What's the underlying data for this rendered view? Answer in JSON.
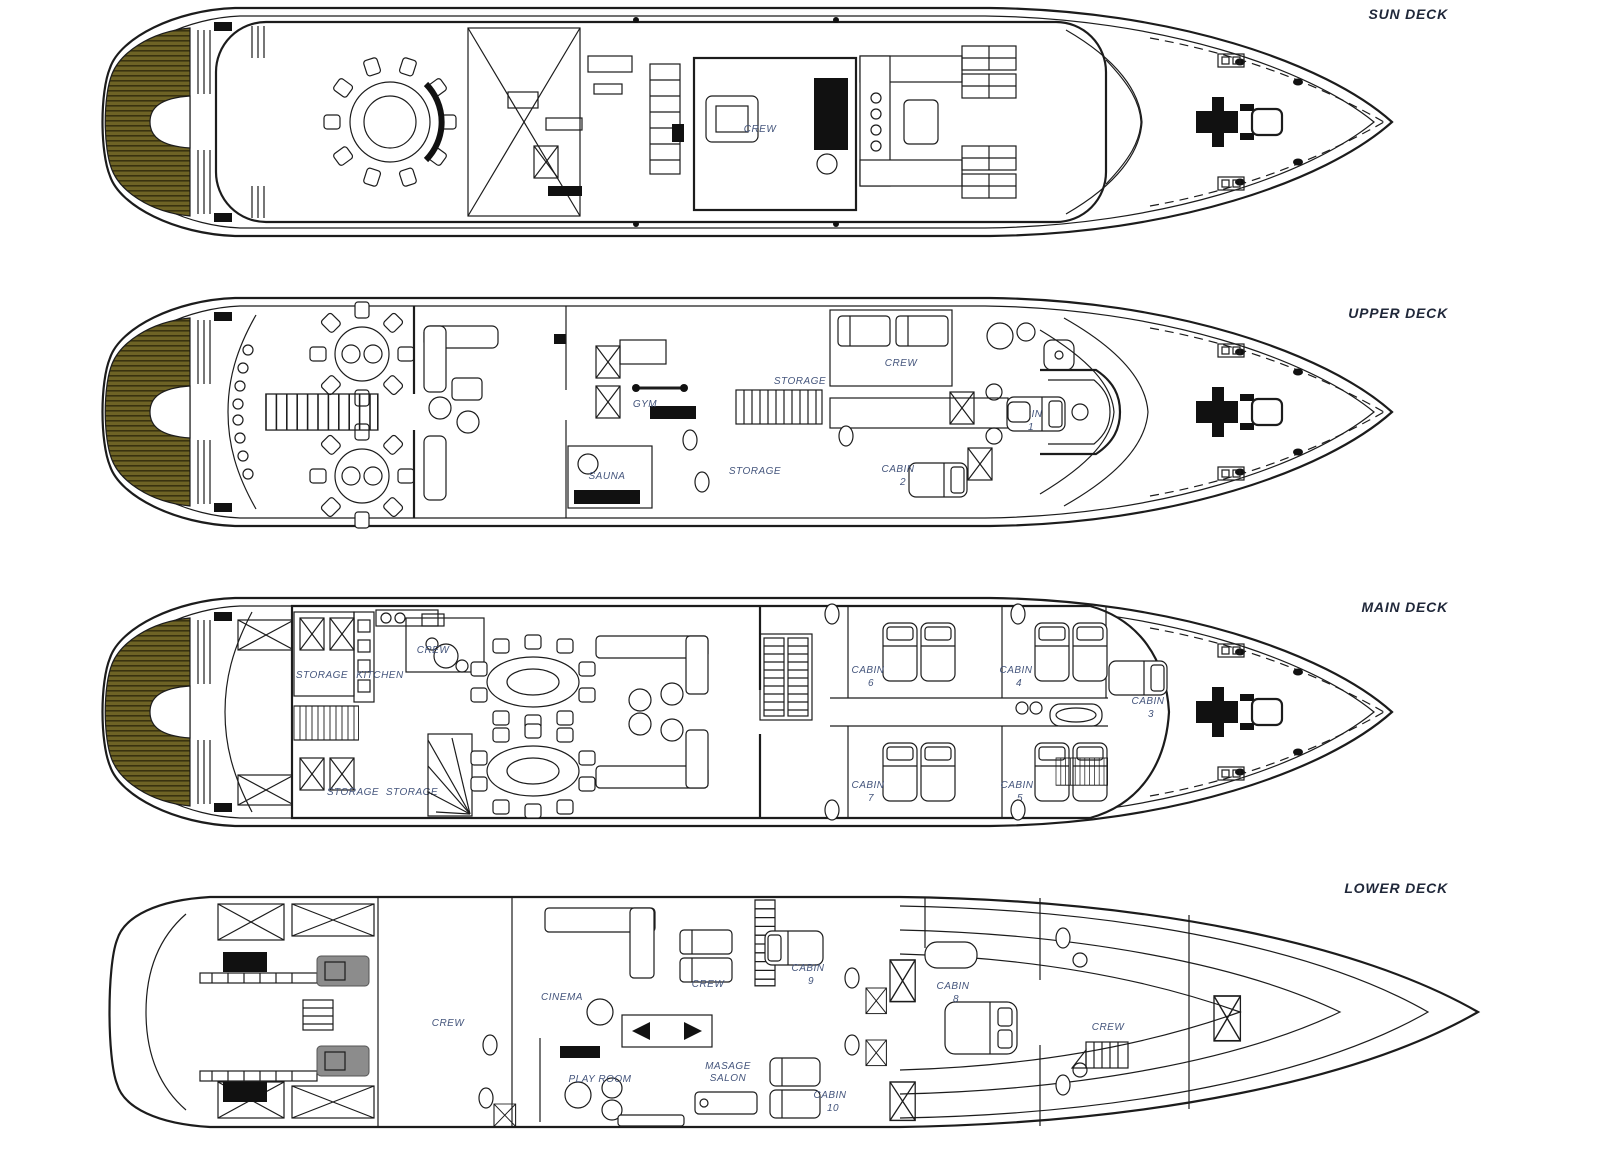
{
  "document": {
    "type": "yacht deck plans",
    "background": "#ffffff"
  },
  "colors": {
    "background": "#ffffff",
    "line": "#1c1c1c",
    "teak": "#6e6325",
    "teak_stripe": "#39320f",
    "label": "#44557c",
    "title": "#20283a",
    "engine_gray": "#8c8c8c",
    "black_fill": "#111111"
  },
  "decks": [
    {
      "name": "SUN DECK",
      "labels": {
        "crew": "CREW"
      }
    },
    {
      "name": "UPPER DECK",
      "labels": {
        "gym": "GYM",
        "sauna": "SAUNA",
        "storage_top": "STORAGE",
        "storage_bottom": "STORAGE",
        "crew": "CREW",
        "cabin1": "CABIN",
        "cabin1_no": "1",
        "cabin2": "CABIN",
        "cabin2_no": "2"
      }
    },
    {
      "name": "MAIN DECK",
      "labels": {
        "storage_aft": "STORAGE",
        "kitchen": "KITCHEN",
        "crew": "CREW",
        "storage_fwd1": "STORAGE",
        "storage_fwd2": "STORAGE",
        "cabin6": "CABIN",
        "cabin6_no": "6",
        "cabin4": "CABIN",
        "cabin4_no": "4",
        "cabin3": "CABIN",
        "cabin3_no": "3",
        "cabin7": "CABIN",
        "cabin7_no": "7",
        "cabin5": "CABIN",
        "cabin5_no": "5"
      }
    },
    {
      "name": "LOWER DECK",
      "labels": {
        "crew_port": "CREW",
        "cinema": "CINEMA",
        "crew_mid": "CREW",
        "play_room": "PLAY ROOM",
        "masage_line1": "MASAGE",
        "masage_line2": "SALON",
        "cabin9": "CABIN",
        "cabin9_no": "9",
        "cabin8": "CABIN",
        "cabin8_no": "8",
        "cabin10": "CABIN",
        "cabin10_no": "10",
        "crew_fwd": "CREW"
      }
    }
  ]
}
